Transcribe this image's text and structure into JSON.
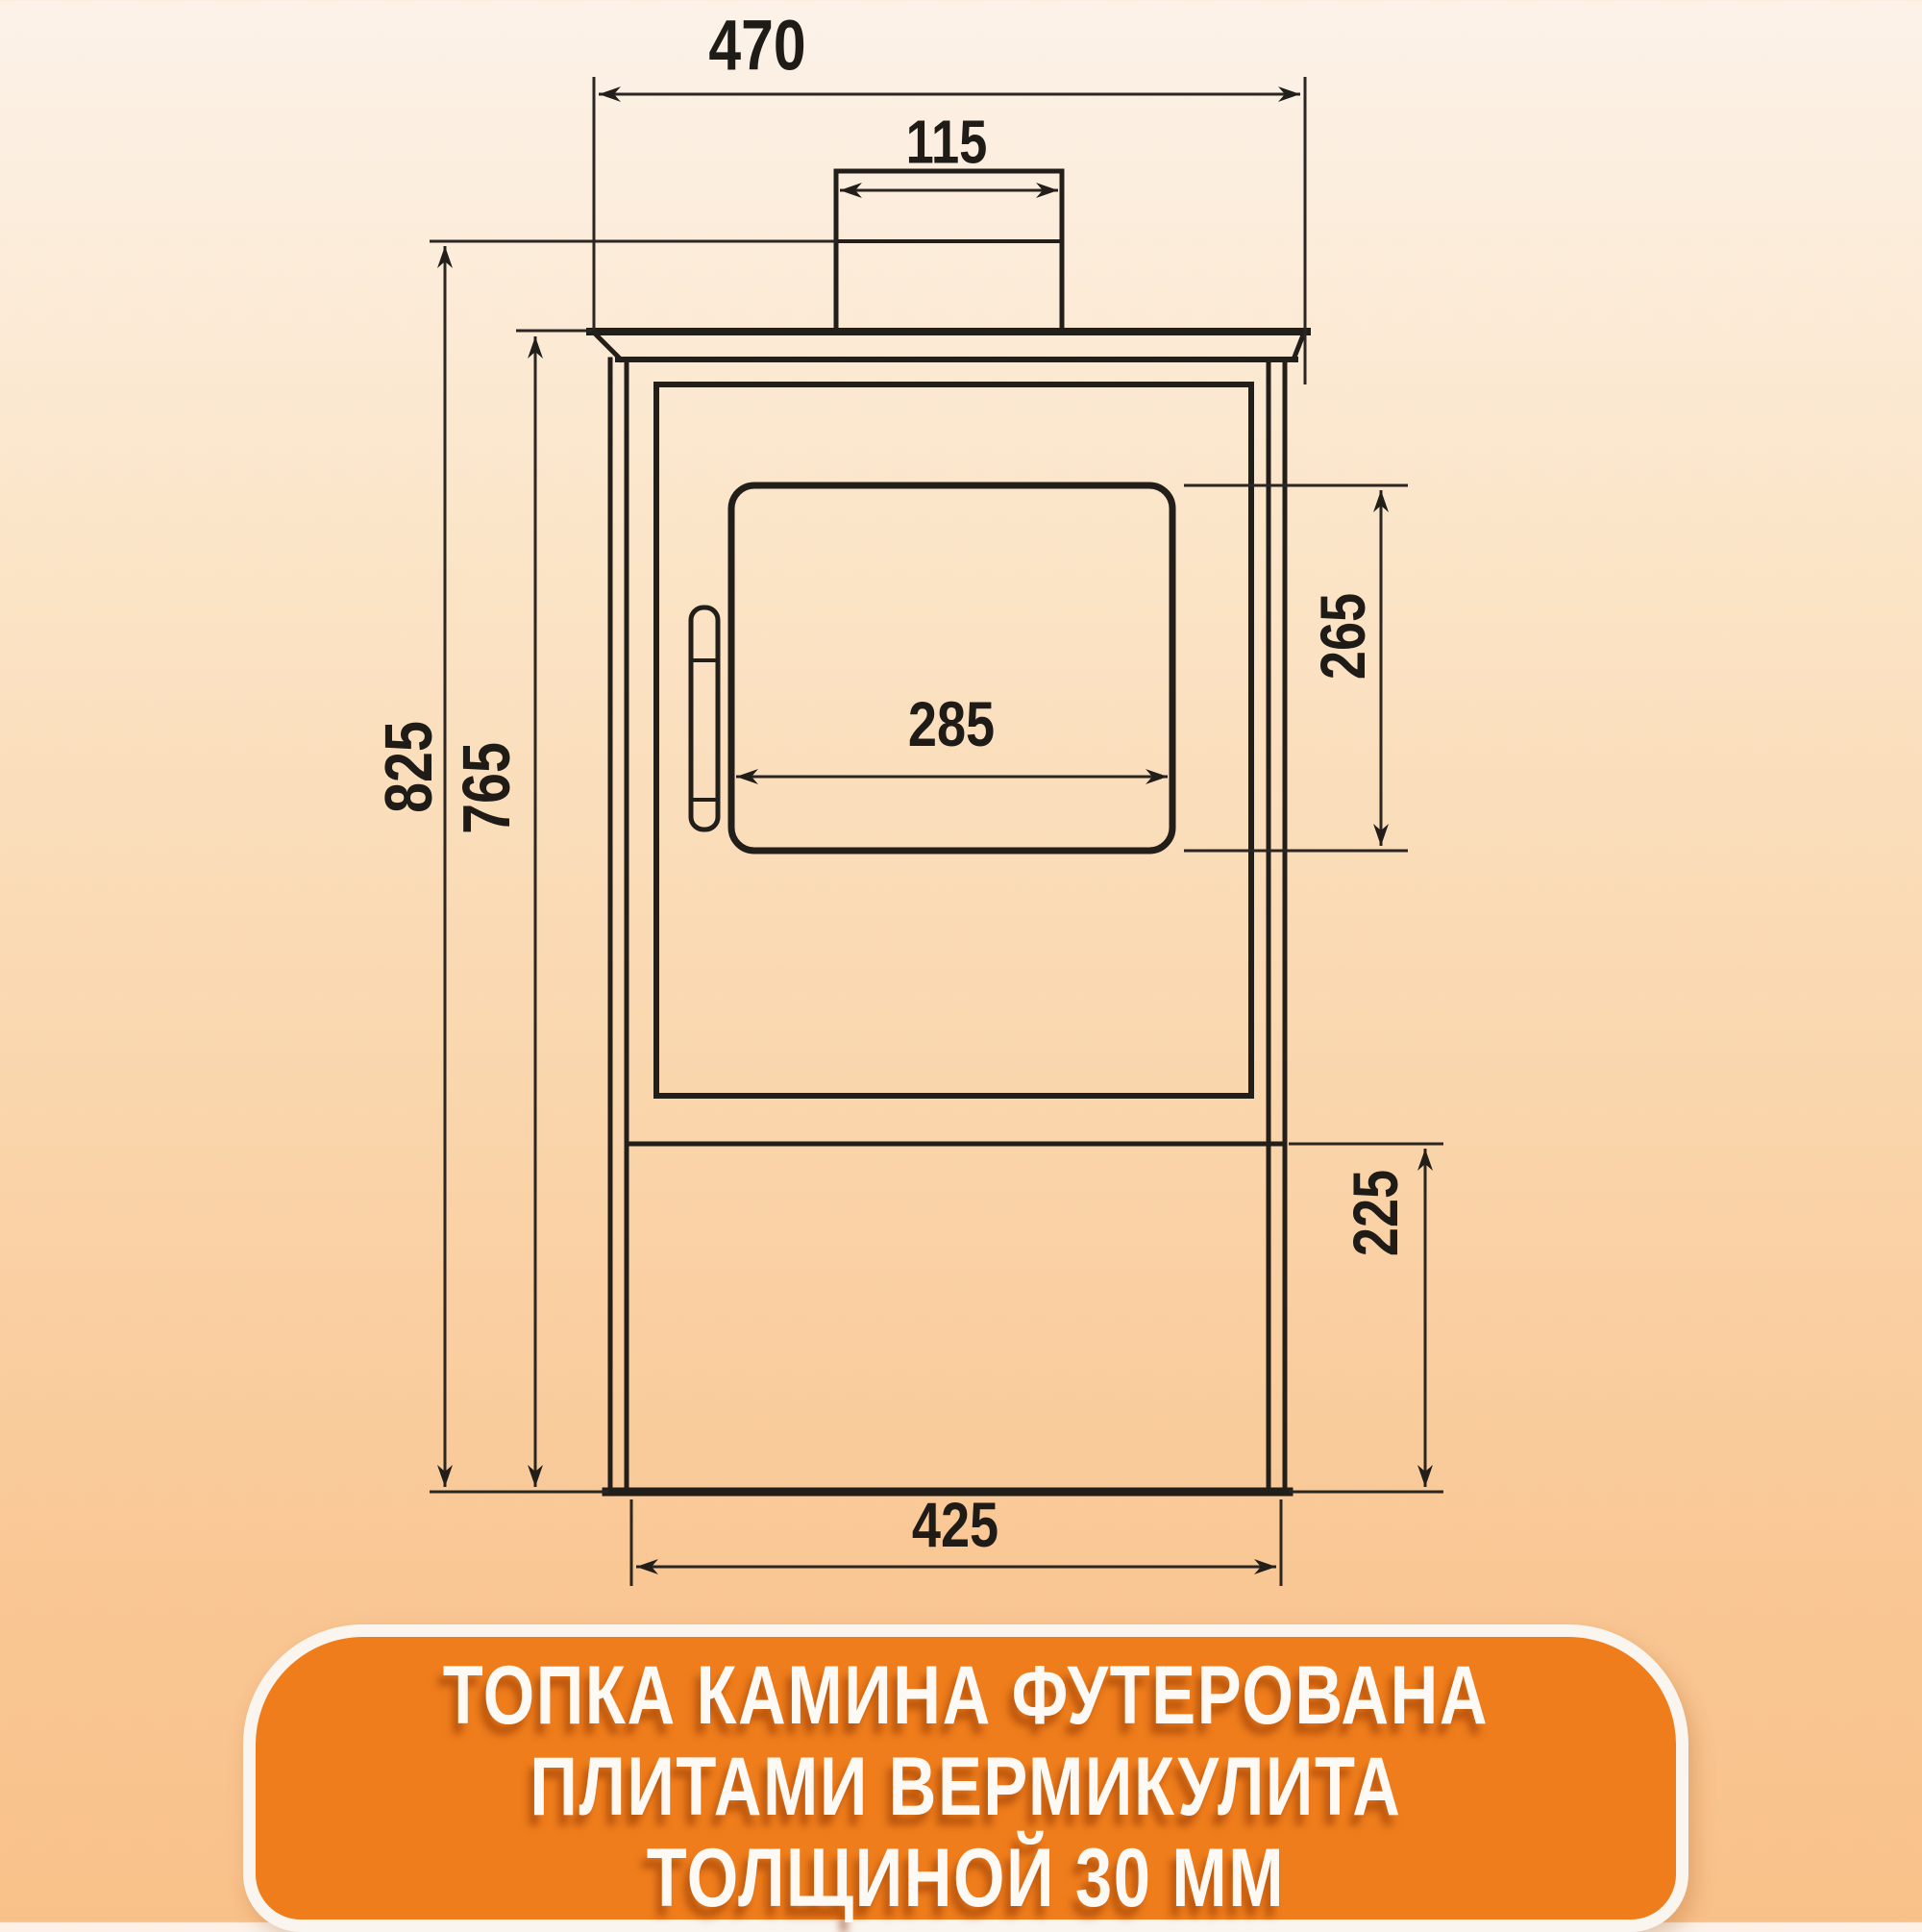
{
  "drawing": {
    "title": "wood-stove front view technical drawing",
    "line_color": "#221e1a",
    "dimensions": {
      "top_plate_width": "470",
      "flue_width": "115",
      "glass_width": "285",
      "glass_height": "265",
      "total_height": "825",
      "body_height": "765",
      "base_height": "225",
      "base_width": "425"
    }
  },
  "banner": {
    "background": "#ef7d1b",
    "border_color": "#fbf5ef",
    "text_color": "#fdf9f5",
    "lines": [
      "ТОПКА КАМИНА ФУТЕРОВАНА",
      "ПЛИТАМИ ВЕРМИКУЛИТА",
      "ТОЛЩИНОЙ 30 ММ"
    ]
  },
  "background": {
    "gradient_top": "#fcf2e9",
    "gradient_bottom": "#f9c18a"
  }
}
